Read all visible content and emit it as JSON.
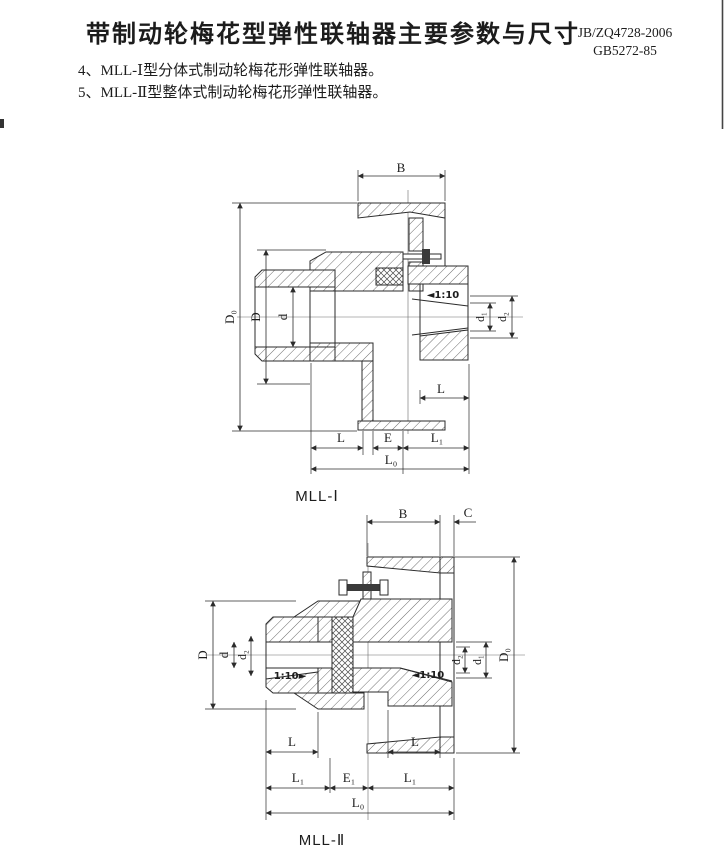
{
  "header": {
    "title": "带制动轮梅花型弹性联轴器主要参数与尺寸",
    "standards": [
      "JB/ZQ4728-2006",
      "GB5272-85"
    ],
    "notes": [
      "4、MLL-Ⅰ型分体式制动轮梅花形弹性联轴器。",
      "5、MLL-Ⅱ型整体式制动轮梅花形弹性联轴器。"
    ]
  },
  "figure1": {
    "caption": "MLL-Ⅰ",
    "dims": {
      "B": "B",
      "D0": "D₀",
      "D": "D",
      "d": "d",
      "taper": "◄1:10",
      "d1": "d₁",
      "d2": "d₂",
      "L_hub": "L",
      "L": "L",
      "E": "E",
      "L1": "L₁",
      "L0": "L₀"
    }
  },
  "figure2": {
    "caption": "MLL-Ⅱ",
    "dims": {
      "B": "B",
      "C": "C",
      "D": "D",
      "d": "d",
      "d2_left": "d₂",
      "taper_left": "1:10►",
      "taper_right": "◄1:10",
      "d2_right": "d₂",
      "d1": "d₁",
      "D0": "D₀",
      "L_left": "L",
      "L_right": "L",
      "L1_left": "L₁",
      "E1": "E₁",
      "L1_right": "L₁",
      "L0": "L₀"
    }
  },
  "colors": {
    "ink": "#1c1c1c",
    "paper": "#ffffff"
  }
}
